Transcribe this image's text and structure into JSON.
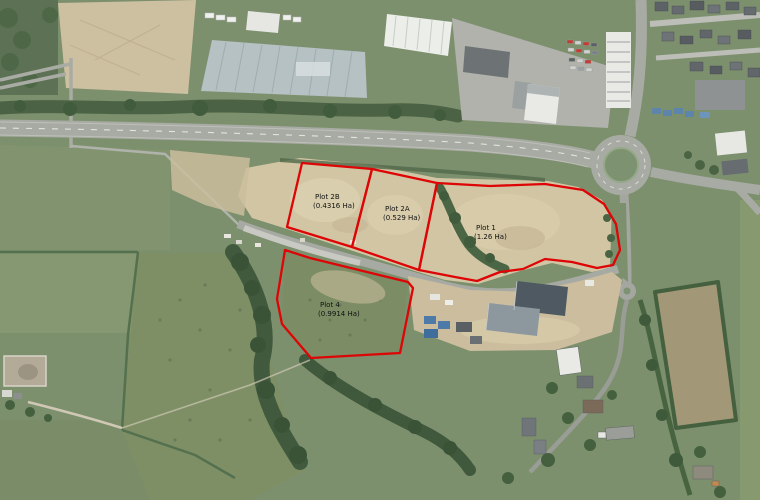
{
  "plots": [
    {
      "id": "2B",
      "name": "Plot 2B",
      "area": "(0.4316 Ha)"
    },
    {
      "id": "2A",
      "name": "Plot 2A",
      "area": "(0.529 Ha)"
    },
    {
      "id": "1",
      "name": "Plot 1",
      "area": "(1.26 Ha)"
    },
    {
      "id": "4",
      "name": "Plot 4",
      "area": "(0.9914 Ha)"
    }
  ],
  "colors": {
    "plot_boundary": "#dd0505",
    "label_text": "#111111"
  }
}
